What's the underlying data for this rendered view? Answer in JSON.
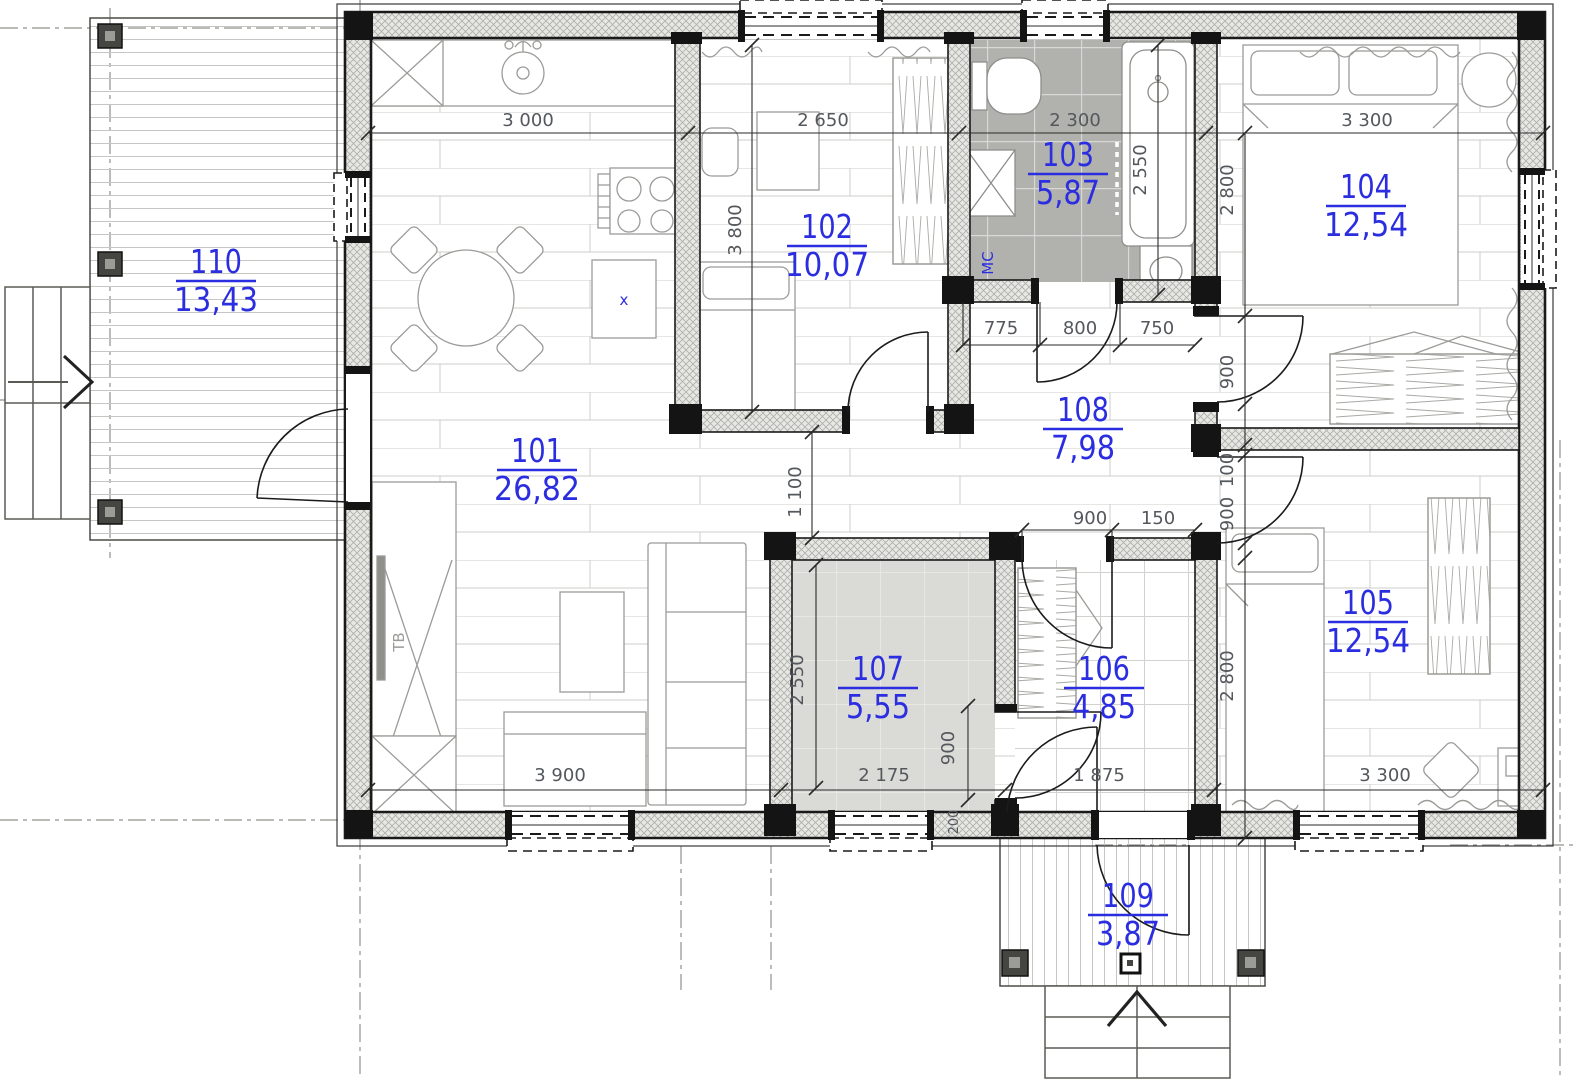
{
  "plan": {
    "type": "architectural-floor-plan",
    "rooms": [
      {
        "number": "101",
        "area": "26,82"
      },
      {
        "number": "102",
        "area": "10,07"
      },
      {
        "number": "103",
        "area": "5,87"
      },
      {
        "number": "104",
        "area": "12,54"
      },
      {
        "number": "105",
        "area": "12,54"
      },
      {
        "number": "106",
        "area": "4,85"
      },
      {
        "number": "107",
        "area": "5,55"
      },
      {
        "number": "108",
        "area": "7,98"
      },
      {
        "number": "109",
        "area": "3,87"
      },
      {
        "number": "110",
        "area": "13,43"
      }
    ],
    "dims": {
      "w_3000": "3 000",
      "w_2650": "2 650",
      "w_2300": "2 300",
      "w_3300_top": "3 300",
      "h_3800": "3 800",
      "h_2550_bath": "2 550",
      "h_2800_104": "2 800",
      "hall_775": "775",
      "hall_800": "800",
      "hall_750": "750",
      "door_104_900": "900",
      "hall_1100": "1 100",
      "door_106_900": "900",
      "door_106_150": "150",
      "door_105_100": "100",
      "door_105_900": "900",
      "h_2800_105": "2 800",
      "h_2550_107": "2 550",
      "door_107_900": "900",
      "t_200": "200",
      "w_3900": "3 900",
      "w_2175": "2 175",
      "w_1875": "1 875",
      "w_3300_bottom": "3 300"
    },
    "annotations": {
      "washing_machine": "МС",
      "tv": "ТВ",
      "kitchen_cross": "x"
    },
    "colors": {
      "room_label": "#2b2de0",
      "dimension_text": "#54575c",
      "wall": "#1a1a1a",
      "bath_floor": "#b1b1ae",
      "storage_floor": "#dadad7",
      "furniture": "#9b9b98"
    }
  }
}
